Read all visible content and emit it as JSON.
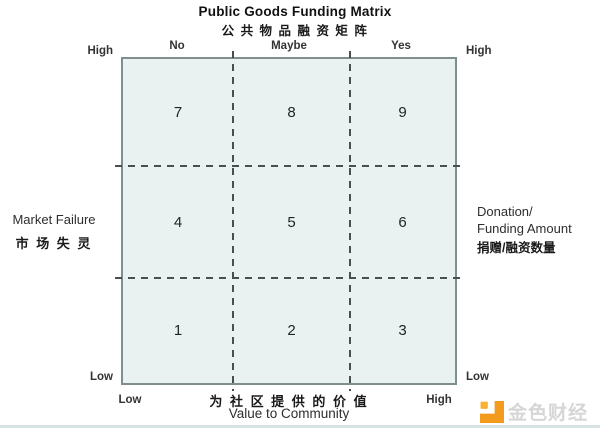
{
  "title": "Public Goods Funding Matrix",
  "subtitle": "公 共 物 品 融 资 矩 阵",
  "matrix": {
    "column_labels": [
      "No",
      "Maybe",
      "Yes"
    ],
    "cells": [
      "7",
      "8",
      "9",
      "4",
      "5",
      "6",
      "1",
      "2",
      "3"
    ]
  },
  "axis_left": {
    "top_tick": "High",
    "bottom_tick": "Low",
    "label_en": "Market Failure",
    "label_zh": "市 场 失 灵"
  },
  "axis_right": {
    "top_tick": "High",
    "bottom_tick": "Low",
    "label_en_line1": "Donation/",
    "label_en_line2": "Funding Amount",
    "label_zh": "捐赠/融资数量"
  },
  "axis_bottom": {
    "left_tick": "Low",
    "right_tick": "High",
    "label_zh": "为 社 区 提 供 的 价 值",
    "label_en": "Value to Community"
  },
  "footer": {
    "brand": "金色财经"
  },
  "colors": {
    "matrix_fill": "#e9f2f1",
    "matrix_border": "#7f8e8e",
    "dash_line": "#45504f",
    "brand_orange": "#f29b1d",
    "brand_orange_light": "#f8b133",
    "brand_text": "#d6d6d6",
    "footer_line": "#d8e2e4"
  }
}
